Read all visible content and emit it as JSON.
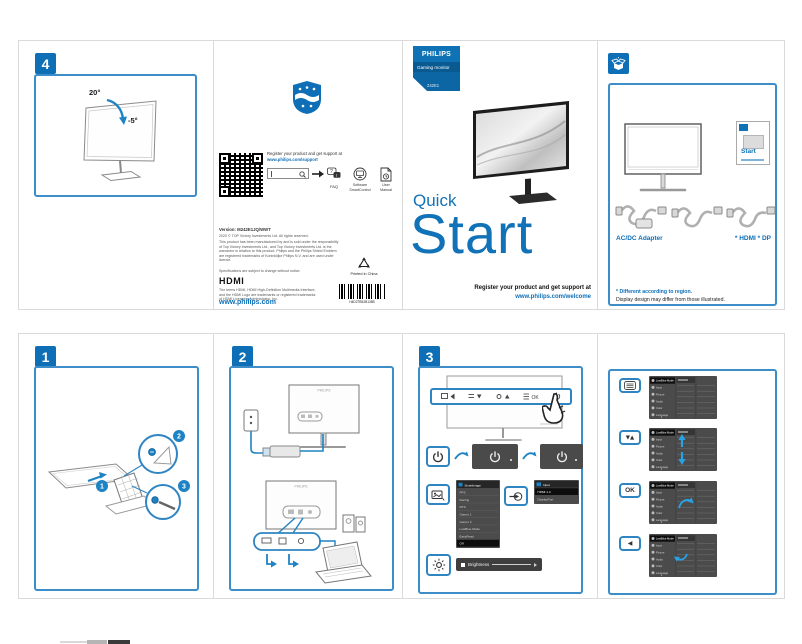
{
  "top": {
    "panel4": {
      "badge": "4",
      "angle_up": "20°",
      "angle_down": "-5°"
    },
    "support": {
      "register_prefix": "Register your product and get support at",
      "register_url": "www.philips.com/support",
      "faq_label": "FAQ",
      "software_label_1": "Software",
      "software_label_2": "SmartControl",
      "manual_label_1": "User",
      "manual_label_2": "Manual",
      "version_line": "Version: M242E1JQ/WWT",
      "copyright_line": "2020 © TOP Victory Investments Ltd. All rights reserved.",
      "legal_text": "This product has been manufactured by and is sold under the responsibility of Top Victory Investments Ltd., and Top Victory Investments Ltd. is the warrantor in relation to this product. Philips and the Philips Shield Emblem are registered trademarks of Koninklijke Philips N.V. and are used under license.",
      "spec_note": "Specifications are subject to change without notice.",
      "hdmi_wordmark": "HDMI",
      "hdmi_note": "The terms HDMI, HDMI High-Definition Multimedia Interface, and the HDMI Logo are trademarks or registered trademarks of HDMI Licensing Administrator, Inc.",
      "website": "www.philips.com",
      "printed_in": "Printed in China",
      "barcode_text": "H4D2TB52B135B"
    },
    "cover": {
      "brand": "PHILIPS",
      "category": "Gaming monitor",
      "model": "242E1",
      "title_line1": "Quick",
      "title_line2": "Start",
      "register_prefix": "Register your product and get support at",
      "register_url": "www.philips.com/welcome"
    },
    "contents": {
      "booklet_title": "Start",
      "adapter_label": "AC/DC Adapter",
      "cable_label": "* HDMI * DP",
      "note_region": "* Different according to region.",
      "note_design": "Display design may differ from those illustrated."
    }
  },
  "bottom": {
    "panel1": {
      "badge": "1",
      "callout_1": "1",
      "callout_2": "2",
      "callout_3": "3"
    },
    "panel2": {
      "badge": "2",
      "brand": "PHILIPS"
    },
    "panel3": {
      "badge": "3",
      "smartimage_title": "SmartImage",
      "smartimage_items": [
        "FPS",
        "Racing",
        "RTS",
        "Gamer 1",
        "Gamer 2",
        "LowBlue Mode",
        "EasyRead",
        "Off"
      ],
      "input_title": "Input",
      "input_items": [
        "HDMI 1.4",
        "DisplayPort"
      ],
      "brightness_label": "Brightness"
    },
    "osd": {
      "updown_button": "▼▲",
      "ok_button": "OK",
      "back_button": "◀",
      "menu_items": [
        "LowBlue Mode",
        "Input",
        "Picture",
        "Audio",
        "Color",
        "Language"
      ]
    }
  }
}
